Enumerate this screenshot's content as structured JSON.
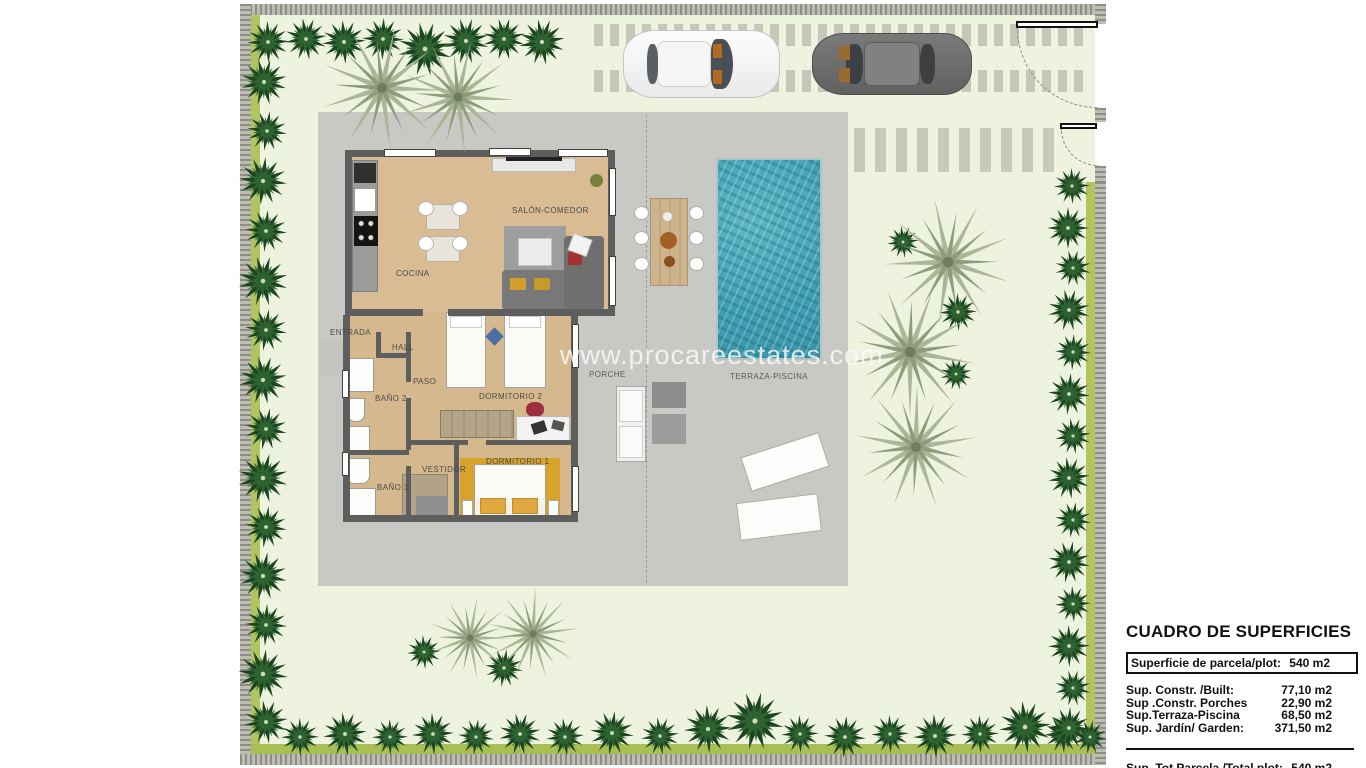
{
  "watermark": "www.procareestates.com",
  "plan": {
    "rooms": [
      {
        "id": "entrada",
        "label": "ENTRADA"
      },
      {
        "id": "hall",
        "label": "HALL"
      },
      {
        "id": "cocina",
        "label": "COCINA"
      },
      {
        "id": "salon",
        "label": "SALÓN-COMEDOR"
      },
      {
        "id": "paso",
        "label": "PASO"
      },
      {
        "id": "bano2",
        "label": "BAÑO 2"
      },
      {
        "id": "dormitorio2",
        "label": "DORMITORIO 2"
      },
      {
        "id": "vestidor",
        "label": "VESTIDOR"
      },
      {
        "id": "bano1",
        "label": "BAÑO 1"
      },
      {
        "id": "dormitorio1",
        "label": "DORMITORIO 1"
      },
      {
        "id": "porche",
        "label": "PORCHE"
      },
      {
        "id": "terraza_piscina",
        "label": "TERRAZA-PISCINA"
      }
    ]
  },
  "areas_table": {
    "title": "CUADRO DE SUPERFICIES",
    "plot_row": {
      "label": "Superficie de parcela/plot:",
      "value": "540 m2"
    },
    "rows": [
      {
        "label": "Sup. Constr. /Built:",
        "value": "77,10 m2"
      },
      {
        "label": "Sup .Constr. Porches",
        "value": "22,90 m2"
      },
      {
        "label": "Sup.Terraza-Piscina",
        "value": "68,50 m2"
      },
      {
        "label": "Sup. Jardín/ Garden:",
        "value": "371,50 m2"
      }
    ],
    "total_row": {
      "label": "Sup. Tot.Parcela /Total plot:",
      "value": "540 m2"
    }
  },
  "colors": {
    "lawn": "#edf3df",
    "hedge": "#b0c45f",
    "boundary_wall": "#a5a59b",
    "terrace": "#c8c8c5",
    "pool_water": "#46a5b6",
    "wood_floor": "#d9bc93",
    "bedroom1_floor": "#d8a32c",
    "interior_wall": "#5e5e5e",
    "tree_dark": "#1d4520",
    "palm_pale": "#a9b394"
  }
}
